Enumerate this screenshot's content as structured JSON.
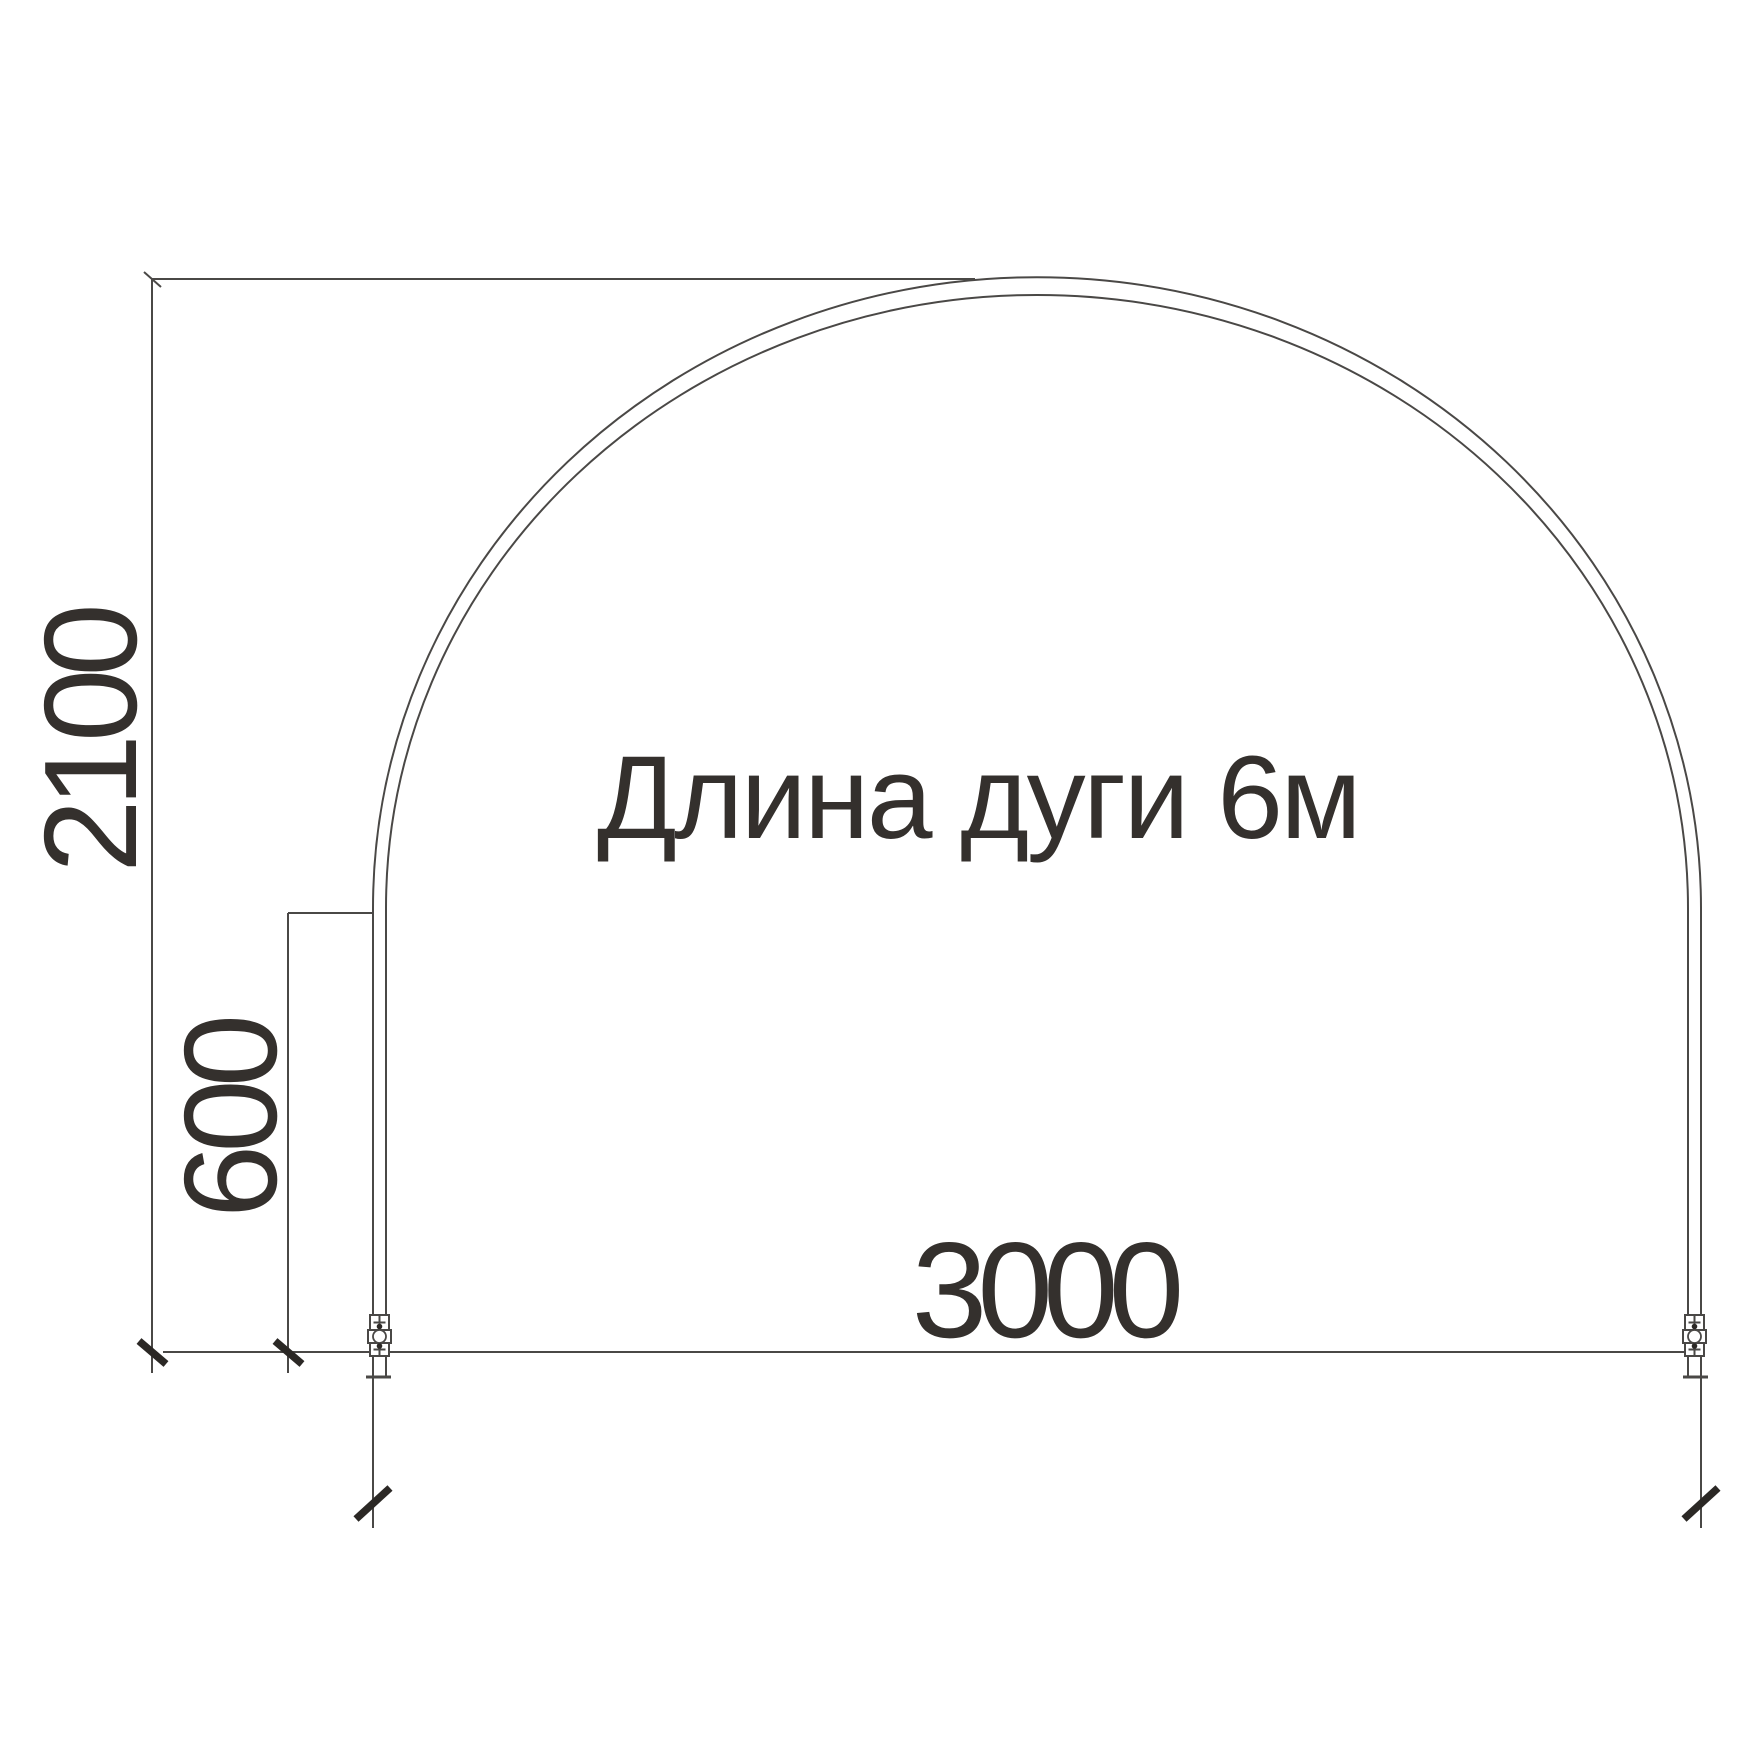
{
  "drawing": {
    "type": "greenhouse-arch-section",
    "annotation": "Длина дуги 6м",
    "dimensions": {
      "height": "2100",
      "leg_height": "600",
      "width": "3000"
    }
  },
  "colors": {
    "line": "#4a4846",
    "tick": "#2b2825",
    "text": "#34302d",
    "fill": "#ffffff",
    "background": "#ffffff"
  }
}
